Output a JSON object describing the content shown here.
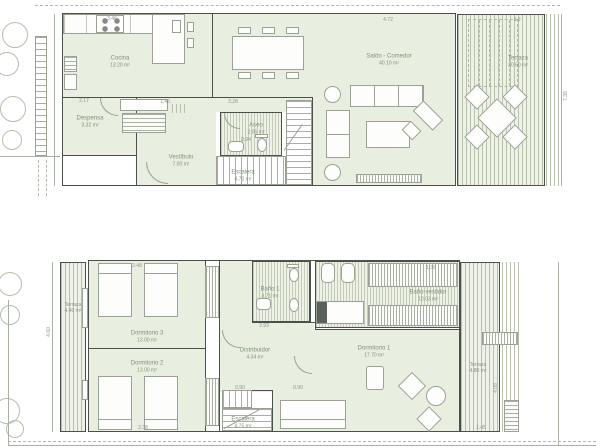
{
  "colors": {
    "room_fill": "#e8eee0",
    "deck_fill": "#eef1e8",
    "deck_line": "#b8c2ac",
    "wall": "#4a514b",
    "furniture_line": "#9aa195",
    "label": "#7f927b",
    "dim": "#8d948c",
    "site_line": "#b5bfaa"
  },
  "ground_floor": {
    "rooms": {
      "cocina": {
        "label": "Cocina",
        "area": "13.20 m²"
      },
      "despensa": {
        "label": "Despensa",
        "area": "3.32 m²"
      },
      "vestibulo": {
        "label": "Vestíbulo",
        "area": "7.00 m²"
      },
      "aseo": {
        "label": "Aseo",
        "area": "2.05 m²"
      },
      "escalera": {
        "label": "Escalera",
        "area": "4.70 m²"
      },
      "salon": {
        "label": "Salón - Comedor",
        "area": "40.10 m²"
      },
      "terraza": {
        "label": "Terraza",
        "area": "20.60 m²"
      }
    },
    "dims": {
      "counter": "3.46",
      "island": "4.72",
      "terrace_top": "3.9",
      "hall_left": "1.46",
      "hall": "3.28",
      "despensa_top": "2.17",
      "aseo_door": "0.94",
      "right_side": "7.38"
    }
  },
  "upper_floor": {
    "rooms": {
      "terraza_izq": {
        "label": "Terraza",
        "area": "4.40 m²"
      },
      "dormitorio3": {
        "label": "Dormitorio 3",
        "area": "13.00 m²"
      },
      "dormitorio2": {
        "label": "Dormitorio 2",
        "area": "13.00 m²"
      },
      "bano1": {
        "label": "Baño 1",
        "area": "3.71 m²"
      },
      "distribuidor": {
        "label": "Distribuidor",
        "area": "4.34 m²"
      },
      "escalera": {
        "label": "Escalera",
        "area": "4.75 m²"
      },
      "dormitorio1": {
        "label": "Dormitorio 1",
        "area": "17.70 m²"
      },
      "bano_vestidor": {
        "label": "Baño-vestidor",
        "area": "10.03 m²"
      },
      "terraza_der": {
        "label": "Terraza",
        "area": "4.80 m²"
      }
    },
    "dims": {
      "bed3_top": "2.48",
      "bed2_bottom": "2.38",
      "wardrobe_top": "1.36",
      "door1": "0.90",
      "door2": "0.90",
      "pasillo": "3.93",
      "terr_bottom": "1.45",
      "terr_side": "4.08",
      "left_side": "4.60"
    }
  }
}
